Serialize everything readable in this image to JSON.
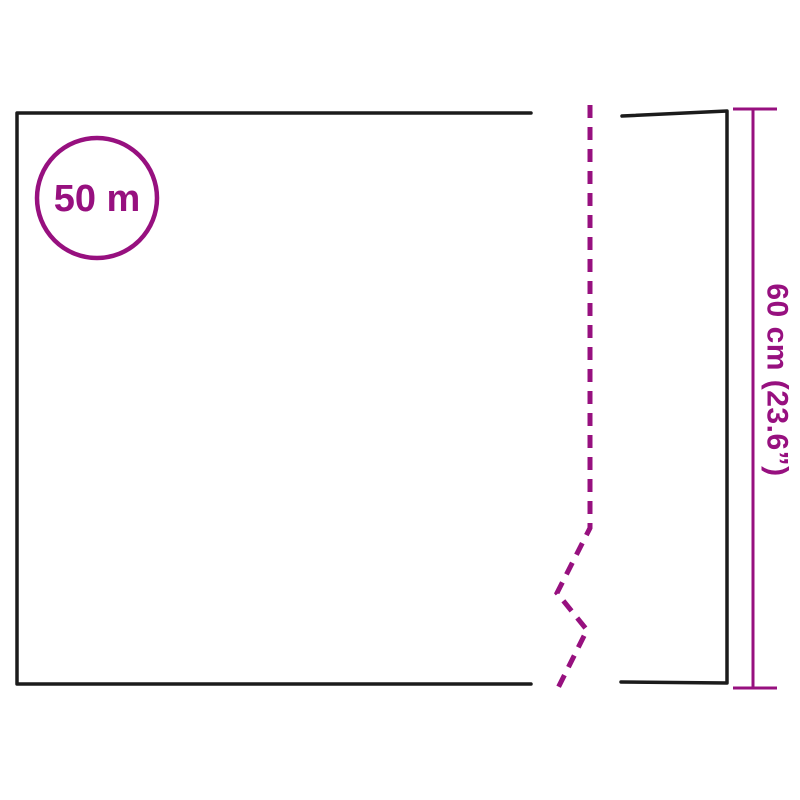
{
  "diagram": {
    "description": "material roll dimension diagram",
    "roll_length_label": "50 m",
    "roll_height_label": "60 cm (23.6”)"
  },
  "colors": {
    "accent": "#97107F",
    "outline": "#1b1b1b",
    "background": "#ffffff"
  }
}
